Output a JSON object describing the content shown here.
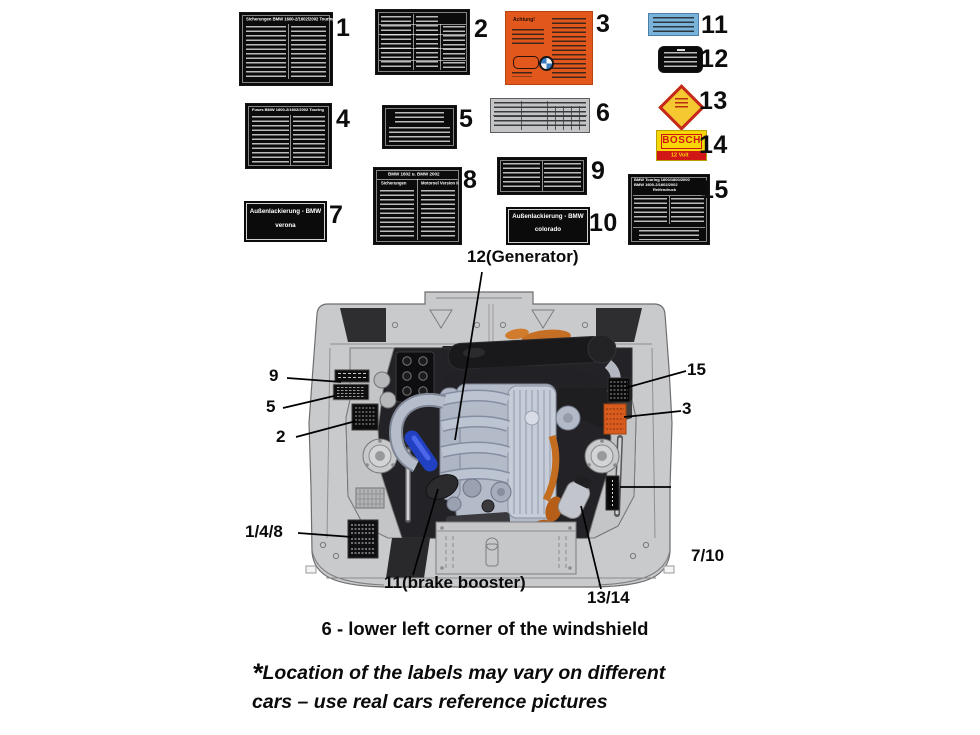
{
  "stickers": {
    "s1": {
      "num": "1",
      "title": "Sicherungen BMW 1600-2/1602/2002 Touring"
    },
    "s2": {
      "num": "2"
    },
    "s3": {
      "num": "3",
      "title": "Achtung!"
    },
    "s4": {
      "num": "4",
      "title": "Fuses BMW 1600-2/1602/2002 Touring"
    },
    "s5": {
      "num": "5"
    },
    "s6": {
      "num": "6"
    },
    "s7": {
      "num": "7",
      "line1": "Außenlackierung - BMW",
      "line2": "verona"
    },
    "s8": {
      "num": "8",
      "header": "BMW 1602 u. BMW 2002",
      "col1": "Sicherungen",
      "col2": "Motoroel Version II"
    },
    "s9": {
      "num": "9"
    },
    "s10": {
      "num": "10",
      "line1": "Außenlackierung - BMW",
      "line2": "colorado"
    },
    "s11": {
      "num": "11"
    },
    "s12": {
      "num": "12"
    },
    "s13": {
      "num": "13"
    },
    "s14": {
      "num": "14",
      "brand": "BOSCH",
      "sub": "12 Volt"
    },
    "s15": {
      "num": "15",
      "header": "BMW Touring 1600/1800/2000",
      "header2": "BMW 1600-2/1602/2002",
      "sub": "Reifendruck"
    }
  },
  "diagram": {
    "callout_12": "12(Generator)",
    "callout_9": "9",
    "callout_5": "5",
    "callout_2": "2",
    "callout_148": "1/4/8",
    "callout_11": "11(brake booster)",
    "callout_1314": "13/14",
    "callout_710": "7/10",
    "callout_15": "15",
    "callout_3": "3",
    "caption": "6 - lower left corner of the windshield"
  },
  "footnote": {
    "asterisk": "*",
    "line1": "Location of the labels may vary on different",
    "line2": "cars – use real cars reference pictures"
  },
  "icons": {
    "bmw_roundel": "quartered blue/white circle",
    "hazard_diamond": "red-bordered yellow diamond"
  },
  "colors": {
    "orange_label": "#e2571b",
    "blue_label": "#7ab3d9",
    "bosch_yellow": "#f6d705",
    "bosch_red": "#d11616",
    "diamond_yellow": "#f5c832",
    "diamond_red": "#c3281a",
    "body_gray": "#c9cacc",
    "bay_dark": "#232327",
    "hose_blue": "#2140c2",
    "engine_orange": "#c56f24"
  }
}
